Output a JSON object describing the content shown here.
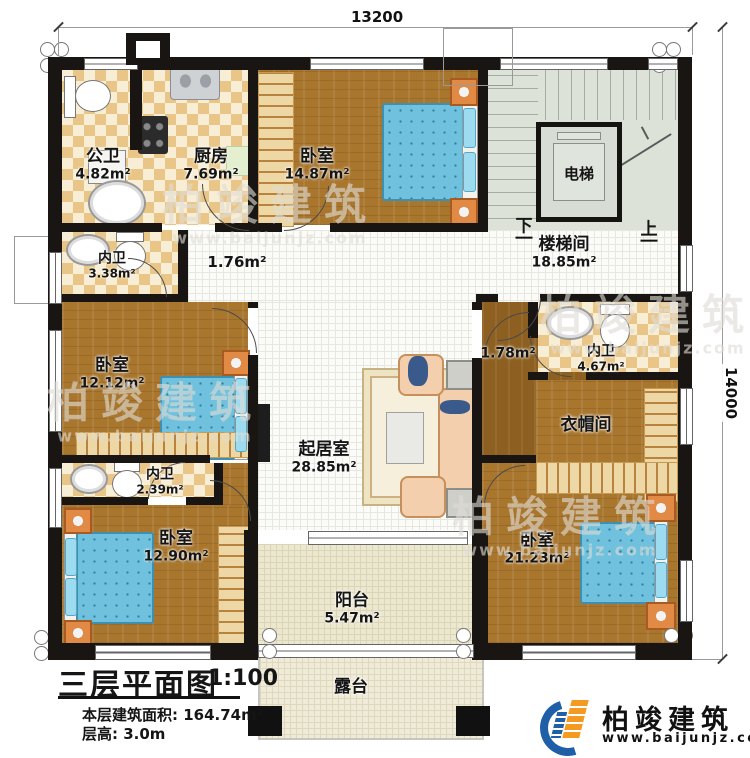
{
  "dimensions": {
    "top": "13200",
    "right": "14000"
  },
  "rooms": {
    "gongwei": {
      "name": "公卫",
      "area": "4.82m²"
    },
    "chufang": {
      "name": "厨房",
      "area": "7.69m²"
    },
    "woshi_top": {
      "name": "卧室",
      "area": "14.87m²"
    },
    "dianti": {
      "name": "电梯"
    },
    "loutijian": {
      "name": "楼梯间",
      "area": "18.85m²"
    },
    "neiwei_top": {
      "name": "内卫",
      "area": "3.38m²"
    },
    "hall_left": {
      "area": "1.76m²"
    },
    "woshi_left": {
      "name": "卧室",
      "area": "12.12m²"
    },
    "qijushi": {
      "name": "起居室",
      "area": "28.85m²"
    },
    "hall_right": {
      "area": "1.78m²"
    },
    "neiwei_right": {
      "name": "内卫",
      "area": "4.67m²"
    },
    "yimaojian": {
      "name": "衣帽间"
    },
    "neiwei_bottom": {
      "name": "内卫",
      "area": "2.39m²"
    },
    "woshi_bl": {
      "name": "卧室",
      "area": "12.90m²"
    },
    "woshi_br": {
      "name": "卧室",
      "area": "21.23m²"
    },
    "yangtai": {
      "name": "阳台",
      "area": "5.47m²"
    },
    "lutai": {
      "name": "露台"
    }
  },
  "stairs": {
    "down": "下",
    "up": "上"
  },
  "title_block": {
    "title": "三层平面图",
    "scale": "1:100",
    "area_label": "本层建筑面积: 164.74m²",
    "floor_height_label": "层高: 3.0m"
  },
  "brand": {
    "name": "柏竣建筑",
    "website": "www.baijunjz.com"
  },
  "watermark": {
    "name": "柏竣建筑",
    "website": "www.baijunjz.com"
  },
  "colors": {
    "wall": "#181512",
    "wood": "#a9762e",
    "tile": "#e9c687",
    "bed": "#6fc1dd",
    "brand_blue": "#1e5fa8",
    "brand_orange": "#f49a20"
  }
}
